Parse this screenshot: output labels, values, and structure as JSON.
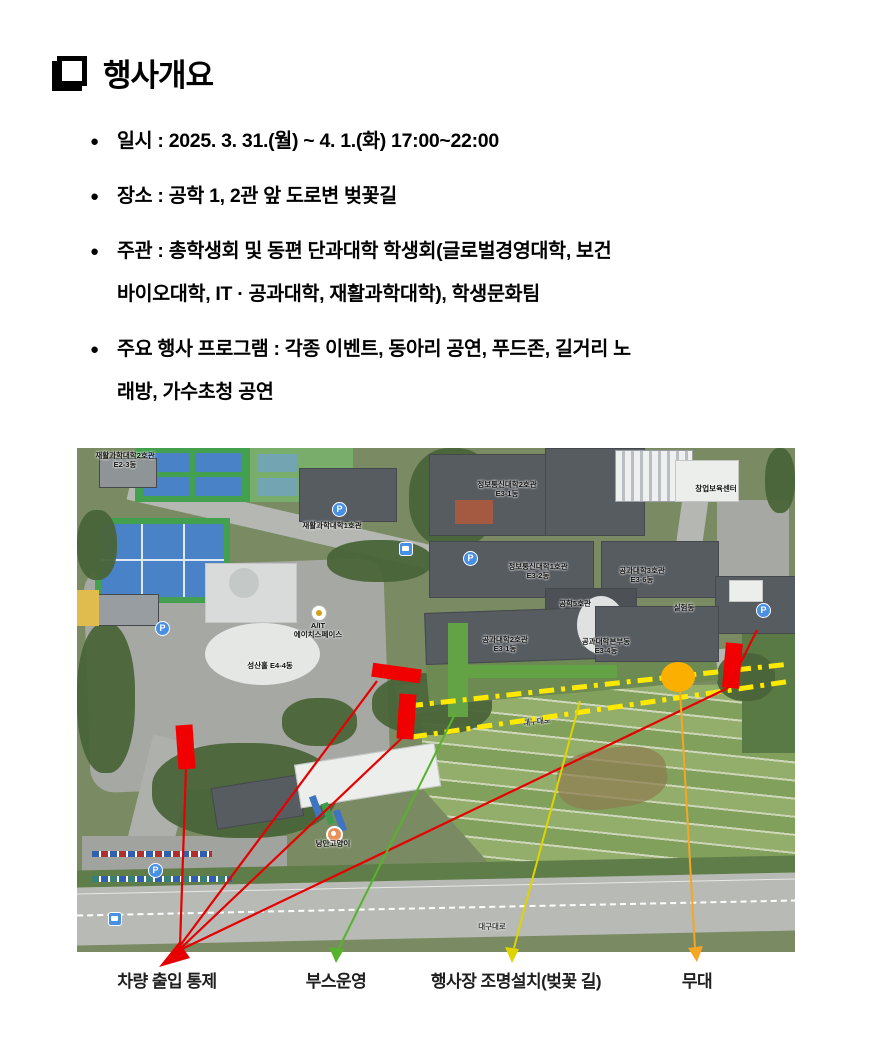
{
  "header": {
    "title": "행사개요"
  },
  "icons": {
    "bullet": "●",
    "parking": "P"
  },
  "bullets": [
    {
      "lines": [
        "일시 : 2025. 3. 31.(월) ~ 4. 1.(화) 17:00~22:00"
      ]
    },
    {
      "lines": [
        "장소 : 공학 1, 2관 앞 도로변 벚꽃길"
      ]
    },
    {
      "lines": [
        "주관 : 총학생회 및 동편 단과대학 학생회(글로벌경영대학, 보건",
        "바이오대학, IT · 공과대학, 재활과학대학), 학생문화팀"
      ]
    },
    {
      "lines": [
        "주요 행사 프로그램 : 각종 이벤트, 동아리 공연, 푸드존, 길거리 노",
        "래방, 가수초청 공연"
      ]
    }
  ],
  "map": {
    "building_labels": [
      "재활과학대학2호관\nE2-3동",
      "재활과학대학1호관",
      "정보통신대학2호관\nE3-1동",
      "창업보육센터",
      "정보통신대학1호관\nE3-2동",
      "공과대학3호관\nE3-6동",
      "공학5호관",
      "실험동",
      "공과대학2호관\nE3-1동",
      "공과대학본부동\nE3-4동",
      "성산홀 E4-4동",
      "A/IT\n에이치스페이스",
      "낭만고양이"
    ],
    "road_labels": [
      "대구대로",
      "대구대로"
    ]
  },
  "annotation_colors": {
    "control_bar": "#f00000",
    "booth_bar": "#64a345",
    "lighting_dash": "#ffe900",
    "stage_circle": "#fbaf00"
  },
  "legend": {
    "items": [
      {
        "label": "차량 출입 통제",
        "color": "#e60000"
      },
      {
        "label": "부스운영",
        "color": "#56b32c"
      },
      {
        "label": "행사장 조명설치(벚꽃 길)",
        "color": "#e0d400"
      },
      {
        "label": "무대",
        "color": "#f5a623"
      }
    ]
  }
}
